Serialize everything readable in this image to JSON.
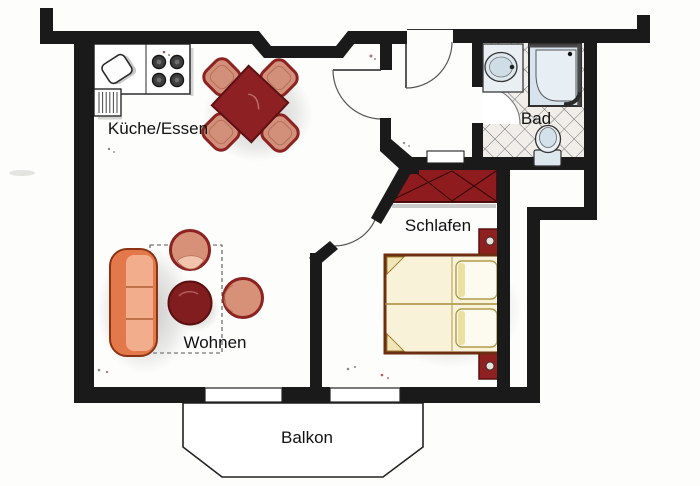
{
  "rooms": {
    "kitchen_dining": {
      "label": "Küche/Essen"
    },
    "bathroom": {
      "label": "Bad"
    },
    "bedroom": {
      "label": "Schlafen"
    },
    "living": {
      "label": "Wohnen"
    },
    "balcony": {
      "label": "Balkon"
    }
  },
  "furniture_icons": [
    "kitchen-counter-icon",
    "stove-burners-icon",
    "kitchen-sink-icon",
    "radiator-icon",
    "dining-table-icon",
    "dining-chair-icon",
    "sofa-icon",
    "coffee-table-icon",
    "armchair-icon",
    "rug-outline",
    "wardrobe-icon",
    "double-bed-icon",
    "pillow-icon",
    "bedpost-icon",
    "washbasin-icon",
    "shower-icon",
    "toilet-icon",
    "door-swing-icon",
    "window-icon",
    "balcony-outline"
  ],
  "colors": {
    "wall": "#1a1a1a",
    "accent_red": "#8e2022",
    "wardrobe_red": "#8e1c1f",
    "chair_salmon": "#d2907a",
    "sofa_orange": "#e3794b",
    "bed_cream": "#f8f2d8",
    "fixture_blue": "#dde8ee",
    "tile_line": "#6b6b6b",
    "label_color": "#111111"
  }
}
